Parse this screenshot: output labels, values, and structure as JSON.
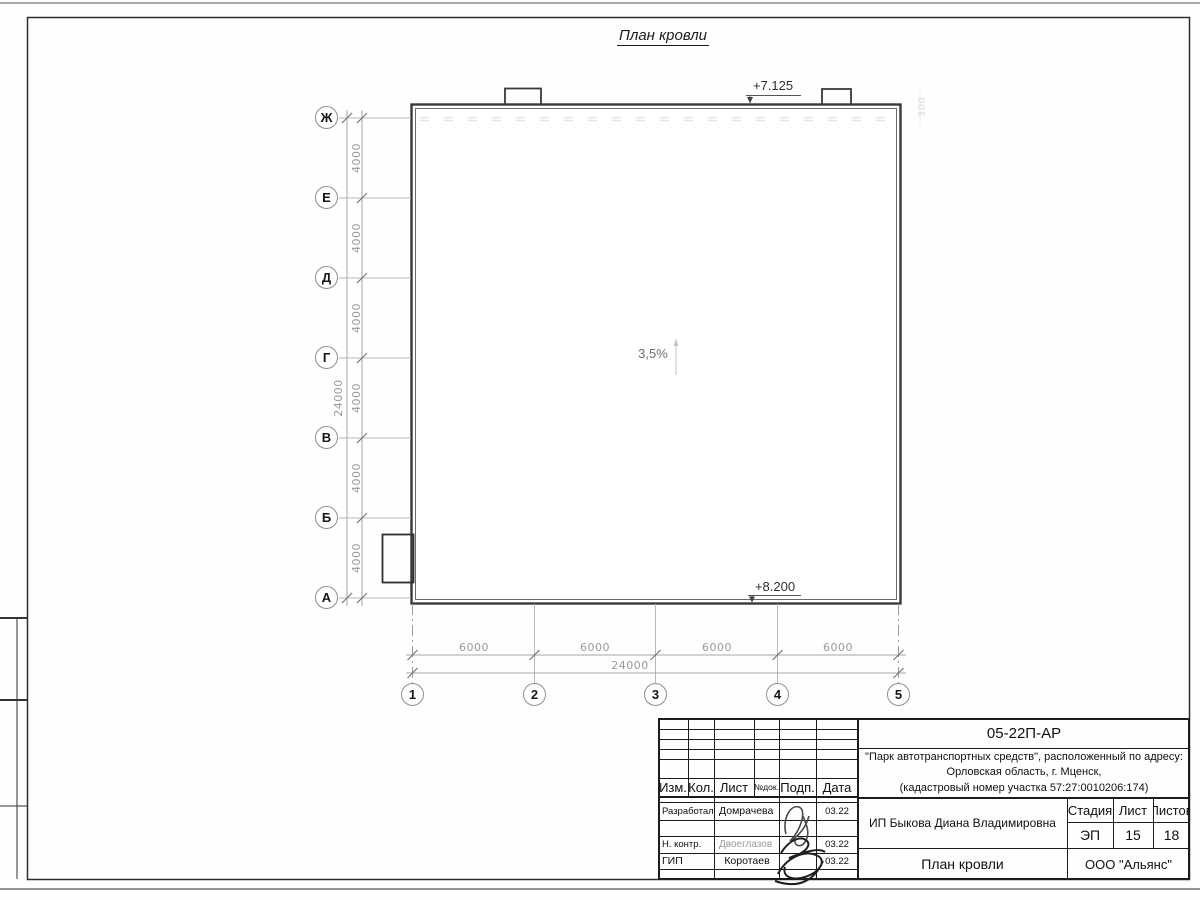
{
  "sheet": {
    "title": "План кровли"
  },
  "plan": {
    "slope": "3,5%",
    "elev_top": "+7.125",
    "elev_bottom": "+8.200",
    "parapet_offset": "300",
    "row_axes": [
      "Ж",
      "Е",
      "Д",
      "Г",
      "В",
      "Б",
      "А"
    ],
    "row_dims": [
      "4000",
      "4000",
      "4000",
      "4000",
      "4000",
      "4000"
    ],
    "row_total": "24000",
    "col_axes": [
      "1",
      "2",
      "3",
      "4",
      "5"
    ],
    "col_dims": [
      "6000",
      "6000",
      "6000",
      "6000"
    ],
    "col_total": "24000"
  },
  "title_block": {
    "doc_code": "05-22П-АР",
    "project": {
      "line1": "\"Парк автотранспортных средств\",  расположенный по адресу:",
      "line2": "Орловская область, г. Мценск,",
      "line3": "(кадастровый номер участка 57:27:0010206:174)"
    },
    "client": "ИП Быкова Диана Владимировна",
    "drawing_title": "План кровли",
    "organization": "ООО \"Альянс\"",
    "columns": {
      "izm": "Изм.",
      "kol": "Кол.",
      "list": "Лист",
      "ndok": "№док.",
      "podp": "Подп.",
      "data": "Дата"
    },
    "stage": {
      "header": "Стадия",
      "value": "ЭП"
    },
    "sheet_no": {
      "header": "Лист",
      "value": "15"
    },
    "sheets_total": {
      "header": "Листов",
      "value": "18"
    },
    "rows": [
      {
        "role": "Разработал",
        "name": "Домрачева",
        "date": "03.22"
      },
      {
        "role": "Н. контр.",
        "name": "Двоеглазов",
        "date": "03.22"
      },
      {
        "role": "ГИП",
        "name": "Коротаев",
        "date": "03.22"
      }
    ]
  }
}
